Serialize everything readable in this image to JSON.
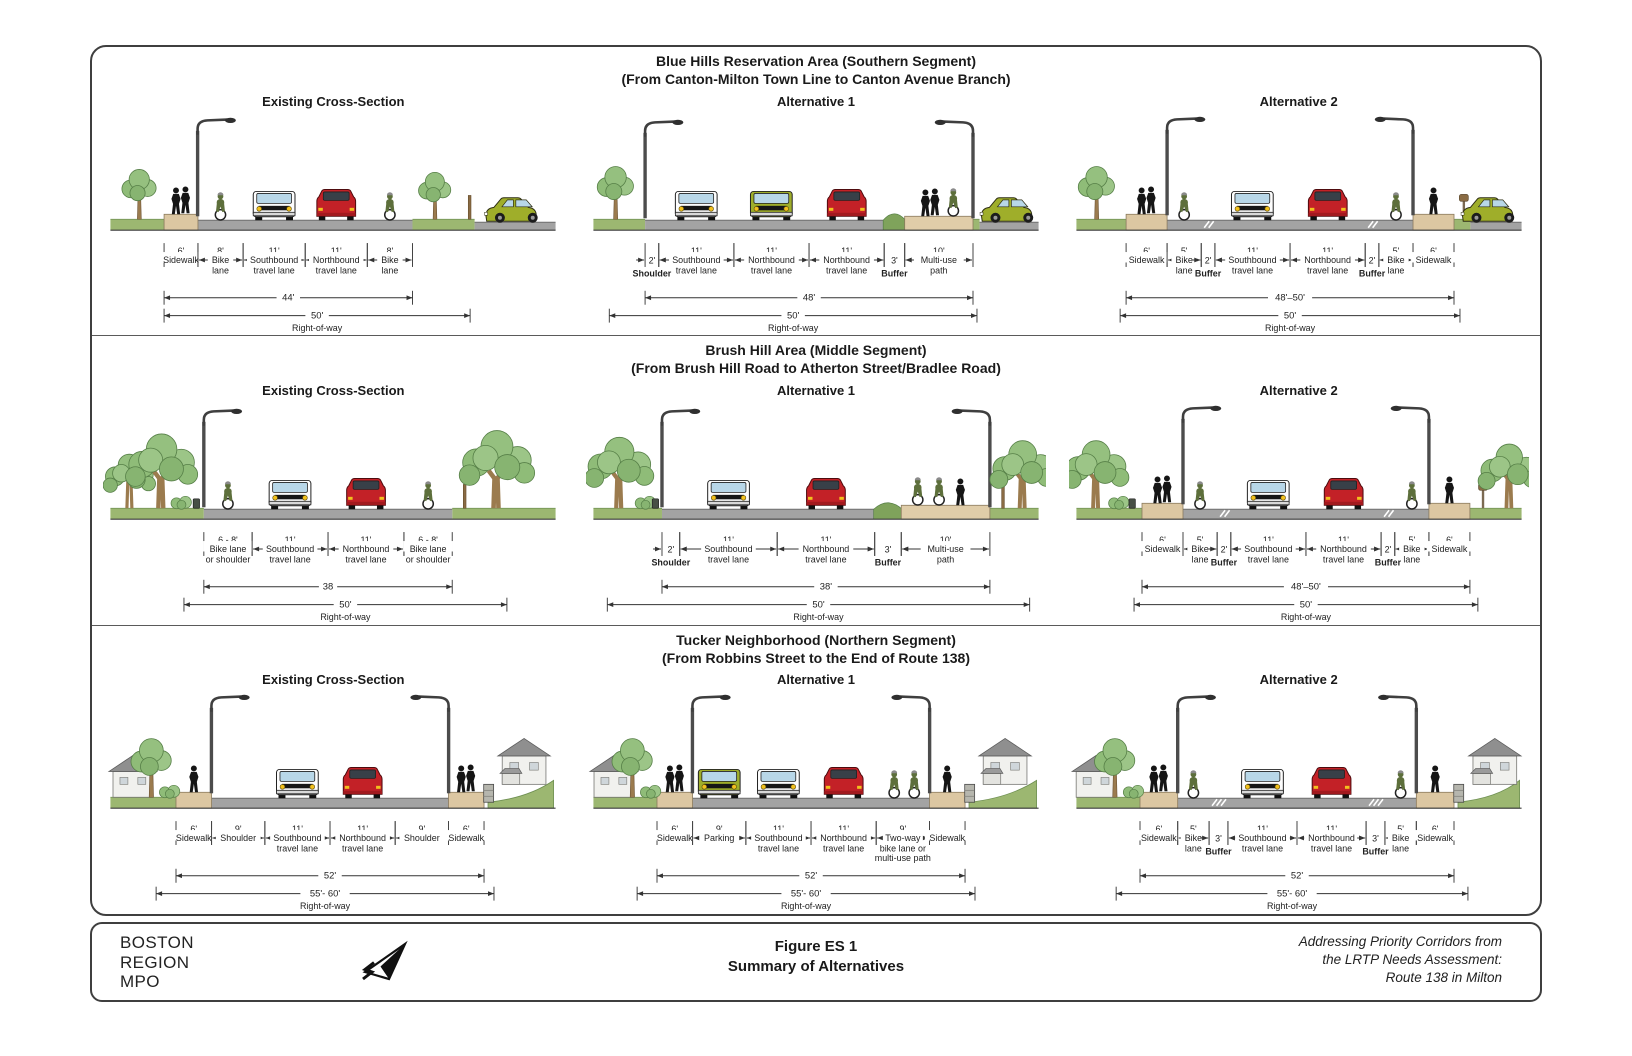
{
  "figure": {
    "footer": {
      "logo_lines": [
        "BOSTON",
        "REGION",
        "MPO"
      ],
      "title": "Figure ES 1",
      "subtitle": "Summary of Alternatives",
      "credit_lines": [
        "Addressing Priority Corridors from",
        "the LRTP Needs Assessment:",
        "Route 138 in Milton"
      ]
    },
    "colors": {
      "road": "#a3a3a3",
      "road_edge": "#6e6e6e",
      "grass": "#9cb771",
      "grass_edge": "#6e8f52",
      "sidewalk": "#dcc7a2",
      "sidewalk_edge": "#8a7a5d",
      "path": "#e0cda9",
      "tree_foliage": "#8fbc78",
      "tree_trunk": "#9b7b4e",
      "car_red": "#c32127",
      "car_green": "#9fae2a",
      "van_white": "#fdfdfd",
      "window_blue": "#b8d7e8",
      "headlight_yellow": "#f2c11e",
      "figure_text": "#1a1a1a"
    },
    "panels": [
      {
        "title": "Blue Hills Reservation Area (Southern Segment)",
        "subtitle": "(From Canton-Milton Town Line to Canton Avenue Branch)",
        "sections": [
          {
            "label": "Existing Cross-Section",
            "segments": [
              {
                "dim": "6'",
                "name": [
                  "Sidewalk"
                ]
              },
              {
                "dim": "8'",
                "name": [
                  "Bike",
                  "lane"
                ]
              },
              {
                "dim": "11'",
                "name": [
                  "Southbound",
                  "travel lane"
                ]
              },
              {
                "dim": "11'",
                "name": [
                  "Northbound",
                  "travel lane"
                ]
              },
              {
                "dim": "8'",
                "name": [
                  "Bike",
                  "lane"
                ]
              }
            ],
            "totals": [
              {
                "dim": "44'",
                "name": ""
              },
              {
                "dim": "50'",
                "name": "Right-of-way"
              }
            ]
          },
          {
            "label": "Alternative 1",
            "segments": [
              {
                "dim": "2'",
                "name": [
                  "Shoulder"
                ]
              },
              {
                "dim": "11'",
                "name": [
                  "Southbound",
                  "travel lane"
                ]
              },
              {
                "dim": "11'",
                "name": [
                  "Northbound",
                  "travel lane"
                ]
              },
              {
                "dim": "11'",
                "name": [
                  "Northbound",
                  "travel lane"
                ]
              },
              {
                "dim": "3'",
                "name": [
                  "Buffer"
                ]
              },
              {
                "dim": "10'",
                "name": [
                  "Multi-use",
                  "path"
                ]
              }
            ],
            "totals": [
              {
                "dim": "48'",
                "name": ""
              },
              {
                "dim": "50'",
                "name": "Right-of-way"
              }
            ]
          },
          {
            "label": "Alternative 2",
            "segments": [
              {
                "dim": "6'",
                "name": [
                  "Sidewalk"
                ]
              },
              {
                "dim": "5'",
                "name": [
                  "Bike",
                  "lane"
                ]
              },
              {
                "dim": "2'",
                "name": [
                  "Buffer"
                ]
              },
              {
                "dim": "11'",
                "name": [
                  "Southbound",
                  "travel lane"
                ]
              },
              {
                "dim": "11'",
                "name": [
                  "Northbound",
                  "travel lane"
                ]
              },
              {
                "dim": "2'",
                "name": [
                  "Buffer"
                ]
              },
              {
                "dim": "5'",
                "name": [
                  "Bike",
                  "lane"
                ]
              },
              {
                "dim": "6'",
                "name": [
                  "Sidewalk"
                ]
              }
            ],
            "totals": [
              {
                "dim": "48'–50'",
                "name": ""
              },
              {
                "dim": "50'",
                "name": "Right-of-way"
              }
            ]
          }
        ]
      },
      {
        "title": "Brush Hill Area (Middle Segment)",
        "subtitle": "(From Brush Hill Road to Atherton Street/Bradlee Road)",
        "sections": [
          {
            "label": "Existing Cross-Section",
            "segments": [
              {
                "dim": "6 - 8'",
                "name": [
                  "Bike lane",
                  "or shoulder"
                ]
              },
              {
                "dim": "11'",
                "name": [
                  "Southbound",
                  "travel lane"
                ]
              },
              {
                "dim": "11'",
                "name": [
                  "Northbound",
                  "travel lane"
                ]
              },
              {
                "dim": "6 - 8'",
                "name": [
                  "Bike lane",
                  "or shoulder"
                ]
              }
            ],
            "totals": [
              {
                "dim": "38",
                "name": ""
              },
              {
                "dim": "50'",
                "name": "Right-of-way"
              }
            ]
          },
          {
            "label": "Alternative 1",
            "segments": [
              {
                "dim": "2'",
                "name": [
                  "Shoulder"
                ]
              },
              {
                "dim": "11'",
                "name": [
                  "Southbound",
                  "travel lane"
                ]
              },
              {
                "dim": "11'",
                "name": [
                  "Northbound",
                  "travel lane"
                ]
              },
              {
                "dim": "3'",
                "name": [
                  "Buffer"
                ]
              },
              {
                "dim": "10'",
                "name": [
                  "Multi-use",
                  "path"
                ]
              }
            ],
            "totals": [
              {
                "dim": "38'",
                "name": ""
              },
              {
                "dim": "50'",
                "name": "Right-of-way"
              }
            ]
          },
          {
            "label": "Alternative 2",
            "segments": [
              {
                "dim": "6'",
                "name": [
                  "Sidewalk"
                ]
              },
              {
                "dim": "5'",
                "name": [
                  "Bike",
                  "lane"
                ]
              },
              {
                "dim": "2'",
                "name": [
                  "Buffer"
                ]
              },
              {
                "dim": "11'",
                "name": [
                  "Southbound",
                  "travel lane"
                ]
              },
              {
                "dim": "11'",
                "name": [
                  "Northbound",
                  "travel lane"
                ]
              },
              {
                "dim": "2'",
                "name": [
                  "Buffer"
                ]
              },
              {
                "dim": "5'",
                "name": [
                  "Bike",
                  "lane"
                ]
              },
              {
                "dim": "6'",
                "name": [
                  "Sidewalk"
                ]
              }
            ],
            "totals": [
              {
                "dim": "48'–50'",
                "name": ""
              },
              {
                "dim": "50'",
                "name": "Right-of-way"
              }
            ]
          }
        ]
      },
      {
        "title": "Tucker Neighborhood (Northern Segment)",
        "subtitle": "(From Robbins Street to the End of Route 138)",
        "sections": [
          {
            "label": "Existing Cross-Section",
            "segments": [
              {
                "dim": "6'",
                "name": [
                  "Sidewalk"
                ]
              },
              {
                "dim": "9'",
                "name": [
                  "Shoulder"
                ]
              },
              {
                "dim": "11'",
                "name": [
                  "Southbound",
                  "travel lane"
                ]
              },
              {
                "dim": "11'",
                "name": [
                  "Northbound",
                  "travel lane"
                ]
              },
              {
                "dim": "9'",
                "name": [
                  "Shoulder"
                ]
              },
              {
                "dim": "6'",
                "name": [
                  "Sidewalk"
                ]
              }
            ],
            "totals": [
              {
                "dim": "52'",
                "name": ""
              },
              {
                "dim": "55'- 60'",
                "name": "Right-of-way"
              }
            ]
          },
          {
            "label": "Alternative 1",
            "segments": [
              {
                "dim": "6'",
                "name": [
                  "Sidewalk"
                ]
              },
              {
                "dim": "9'",
                "name": [
                  "Parking"
                ]
              },
              {
                "dim": "11'",
                "name": [
                  "Southbound",
                  "travel lane"
                ]
              },
              {
                "dim": "11'",
                "name": [
                  "Northbound",
                  "travel lane"
                ]
              },
              {
                "dim": "9'",
                "name": [
                  "Two-way",
                  "bike lane or",
                  "multi-use path"
                ]
              },
              {
                "dim": "",
                "name": [
                  "Sidewalk"
                ]
              }
            ],
            "totals": [
              {
                "dim": "52'",
                "name": ""
              },
              {
                "dim": "55'- 60'",
                "name": "Right-of-way"
              }
            ]
          },
          {
            "label": "Alternative 2",
            "segments": [
              {
                "dim": "6'",
                "name": [
                  "Sidewalk"
                ]
              },
              {
                "dim": "5'",
                "name": [
                  "Bike",
                  "lane"
                ]
              },
              {
                "dim": "3'",
                "name": [
                  "Buffer"
                ]
              },
              {
                "dim": "11'",
                "name": [
                  "Southbound",
                  "travel lane"
                ]
              },
              {
                "dim": "11'",
                "name": [
                  "Northbound",
                  "travel lane"
                ]
              },
              {
                "dim": "3'",
                "name": [
                  "Buffer"
                ]
              },
              {
                "dim": "5'",
                "name": [
                  "Bike",
                  "lane"
                ]
              },
              {
                "dim": "6'",
                "name": [
                  "Sidewalk"
                ]
              }
            ],
            "totals": [
              {
                "dim": "52'",
                "name": ""
              },
              {
                "dim": "55'- 60'",
                "name": "Right-of-way"
              }
            ]
          }
        ]
      }
    ]
  }
}
